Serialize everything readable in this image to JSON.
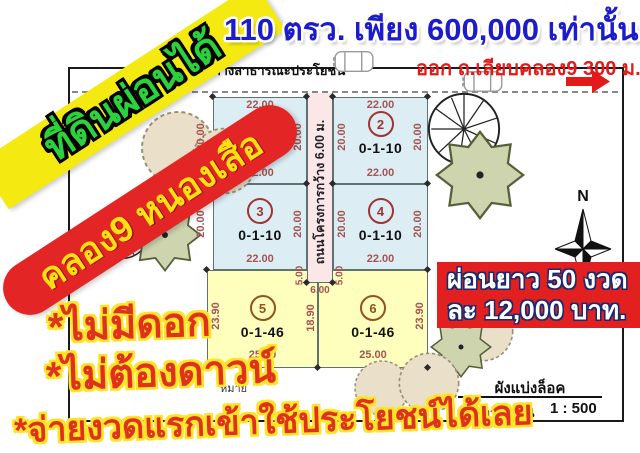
{
  "headline": "110 ตรว. เพียง 600,000 เท่านั้น",
  "left_banner": {
    "text": "ที่ดินผ่อนได้",
    "bg_color": "#f4ea12",
    "text_color": "#2bd23c"
  },
  "location_banner": {
    "text": "คลอง9 หนองเสือ",
    "bg_color": "#e42525",
    "text_color": "#ffdf12"
  },
  "exit_label": {
    "text": "ออก ถ.เลียบคลอง9  300 ม.",
    "color": "#e31a1a"
  },
  "payment_banner": {
    "line1": "ผ่อนยาว 50 งวด",
    "line2": "ละ 12,000 บาท.",
    "bg_color": "#e32020",
    "text_color": "#ffffff"
  },
  "selling_points": {
    "line1": "*ไม่มีดอก",
    "line2": "*ไม่ต้องดาวน์",
    "line3": "*จ่ายงวดแรกเข้าใช้ประโยชน์ได้เลย",
    "text_color": "#e0301e",
    "outline_color": "#ffe427"
  },
  "plan": {
    "public_road_label": "ทางสาธารณะประโยชน์",
    "project_road_label": "ถนนโครงการกว้าง 6.00 ม.",
    "compass_label": "N",
    "note_label": "หมาย",
    "legend": {
      "title": "ผังแบ่งล็อค",
      "scale_label": "มาตราส่วน",
      "scale_value": "1 : 500"
    },
    "dims": {
      "blue_width": "22.00",
      "blue_depth": "20.00",
      "yellow_width": "25.00",
      "yellow_depth": "23.90",
      "yellow_mid": "18.90",
      "notch": "5.00",
      "road_width": "6.00"
    },
    "plots": [
      {
        "number": "1",
        "size": "0-1-10"
      },
      {
        "number": "2",
        "size": "0-1-10"
      },
      {
        "number": "3",
        "size": "0-1-10"
      },
      {
        "number": "4",
        "size": "0-1-10"
      },
      {
        "number": "5",
        "size": "0-1-46"
      },
      {
        "number": "6",
        "size": "0-1-46"
      }
    ],
    "colors": {
      "blue_plot": "#dcedf4",
      "yellow_plot": "#feffbc",
      "road": "#fbe7e8",
      "dimension_text": "#a65353",
      "plot_number_blue": "#a03434",
      "plot_number_yellow": "#95501c"
    }
  }
}
